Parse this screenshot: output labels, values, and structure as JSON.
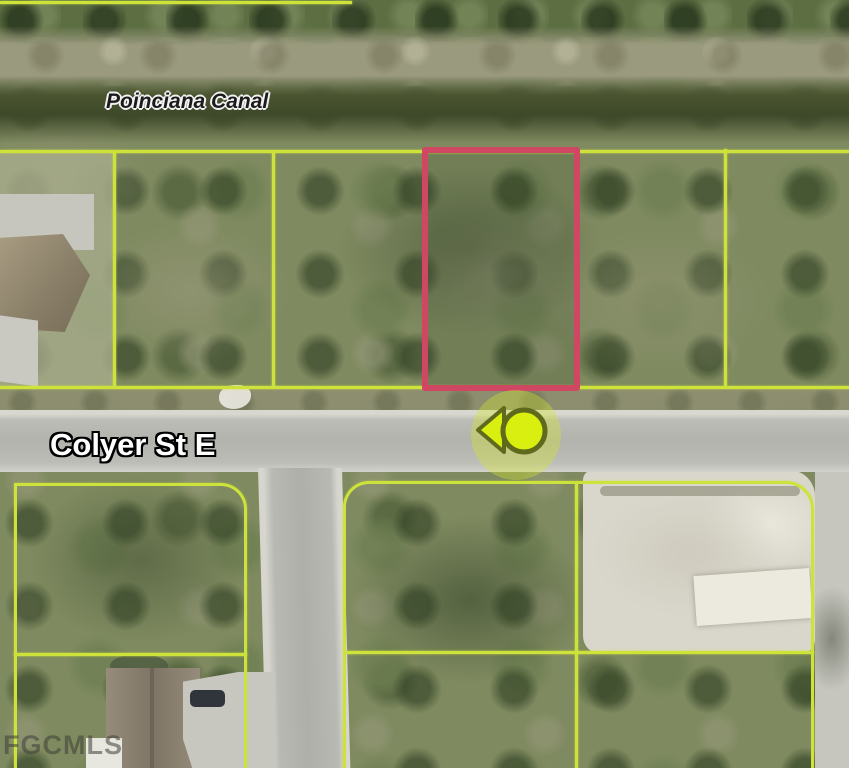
{
  "map": {
    "type": "aerial-parcel-map",
    "labels": {
      "canal": "Poinciana Canal",
      "street": "Colyer St E",
      "watermark": "FGCMLS"
    },
    "subject_parcel": {
      "outline_color": "#cf4762",
      "location": "north side of Colyer St E, south of Poinciana Canal"
    },
    "parcel_lines_color": "#cde23a",
    "marker": {
      "shape": "circle-with-left-arrow",
      "fill": "#d8ef10",
      "ring": "#5f6a1d",
      "halo": "rgba(210,228,50,0.38)"
    },
    "colors": {
      "canal_water": "#3e492a",
      "road": "#b2b3ad",
      "vegetation": "#7f8a60"
    }
  }
}
